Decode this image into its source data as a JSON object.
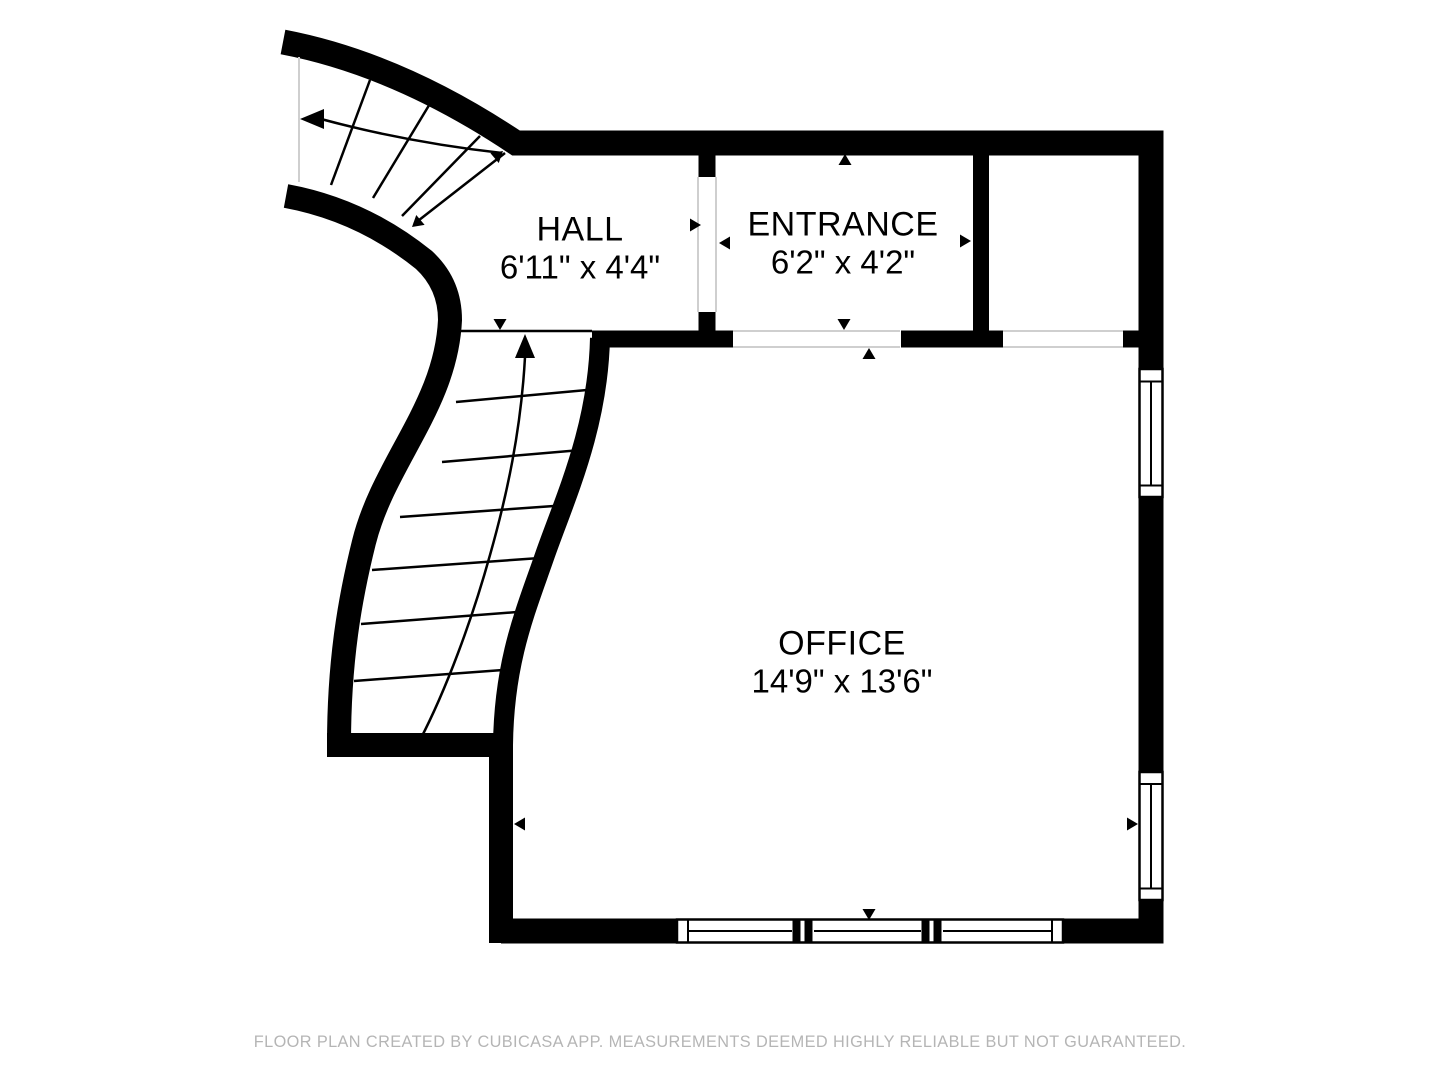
{
  "rooms": [
    {
      "id": "hall",
      "name": "HALL",
      "dimensions": "6'11\" x 4'4\""
    },
    {
      "id": "entrance",
      "name": "ENTRANCE",
      "dimensions": "6'2\" x 4'2\""
    },
    {
      "id": "office",
      "name": "OFFICE",
      "dimensions": "14'9\" x 13'6\""
    }
  ],
  "footer": {
    "text": "FLOOR PLAN CREATED BY CUBICASA APP. MEASUREMENTS DEEMED HIGHLY RELIABLE BUT NOT GUARANTEED."
  },
  "colors": {
    "wall": "#000000",
    "background": "#ffffff",
    "footer_text": "#b5b5b5",
    "opening_line": "#cfcfcf"
  }
}
